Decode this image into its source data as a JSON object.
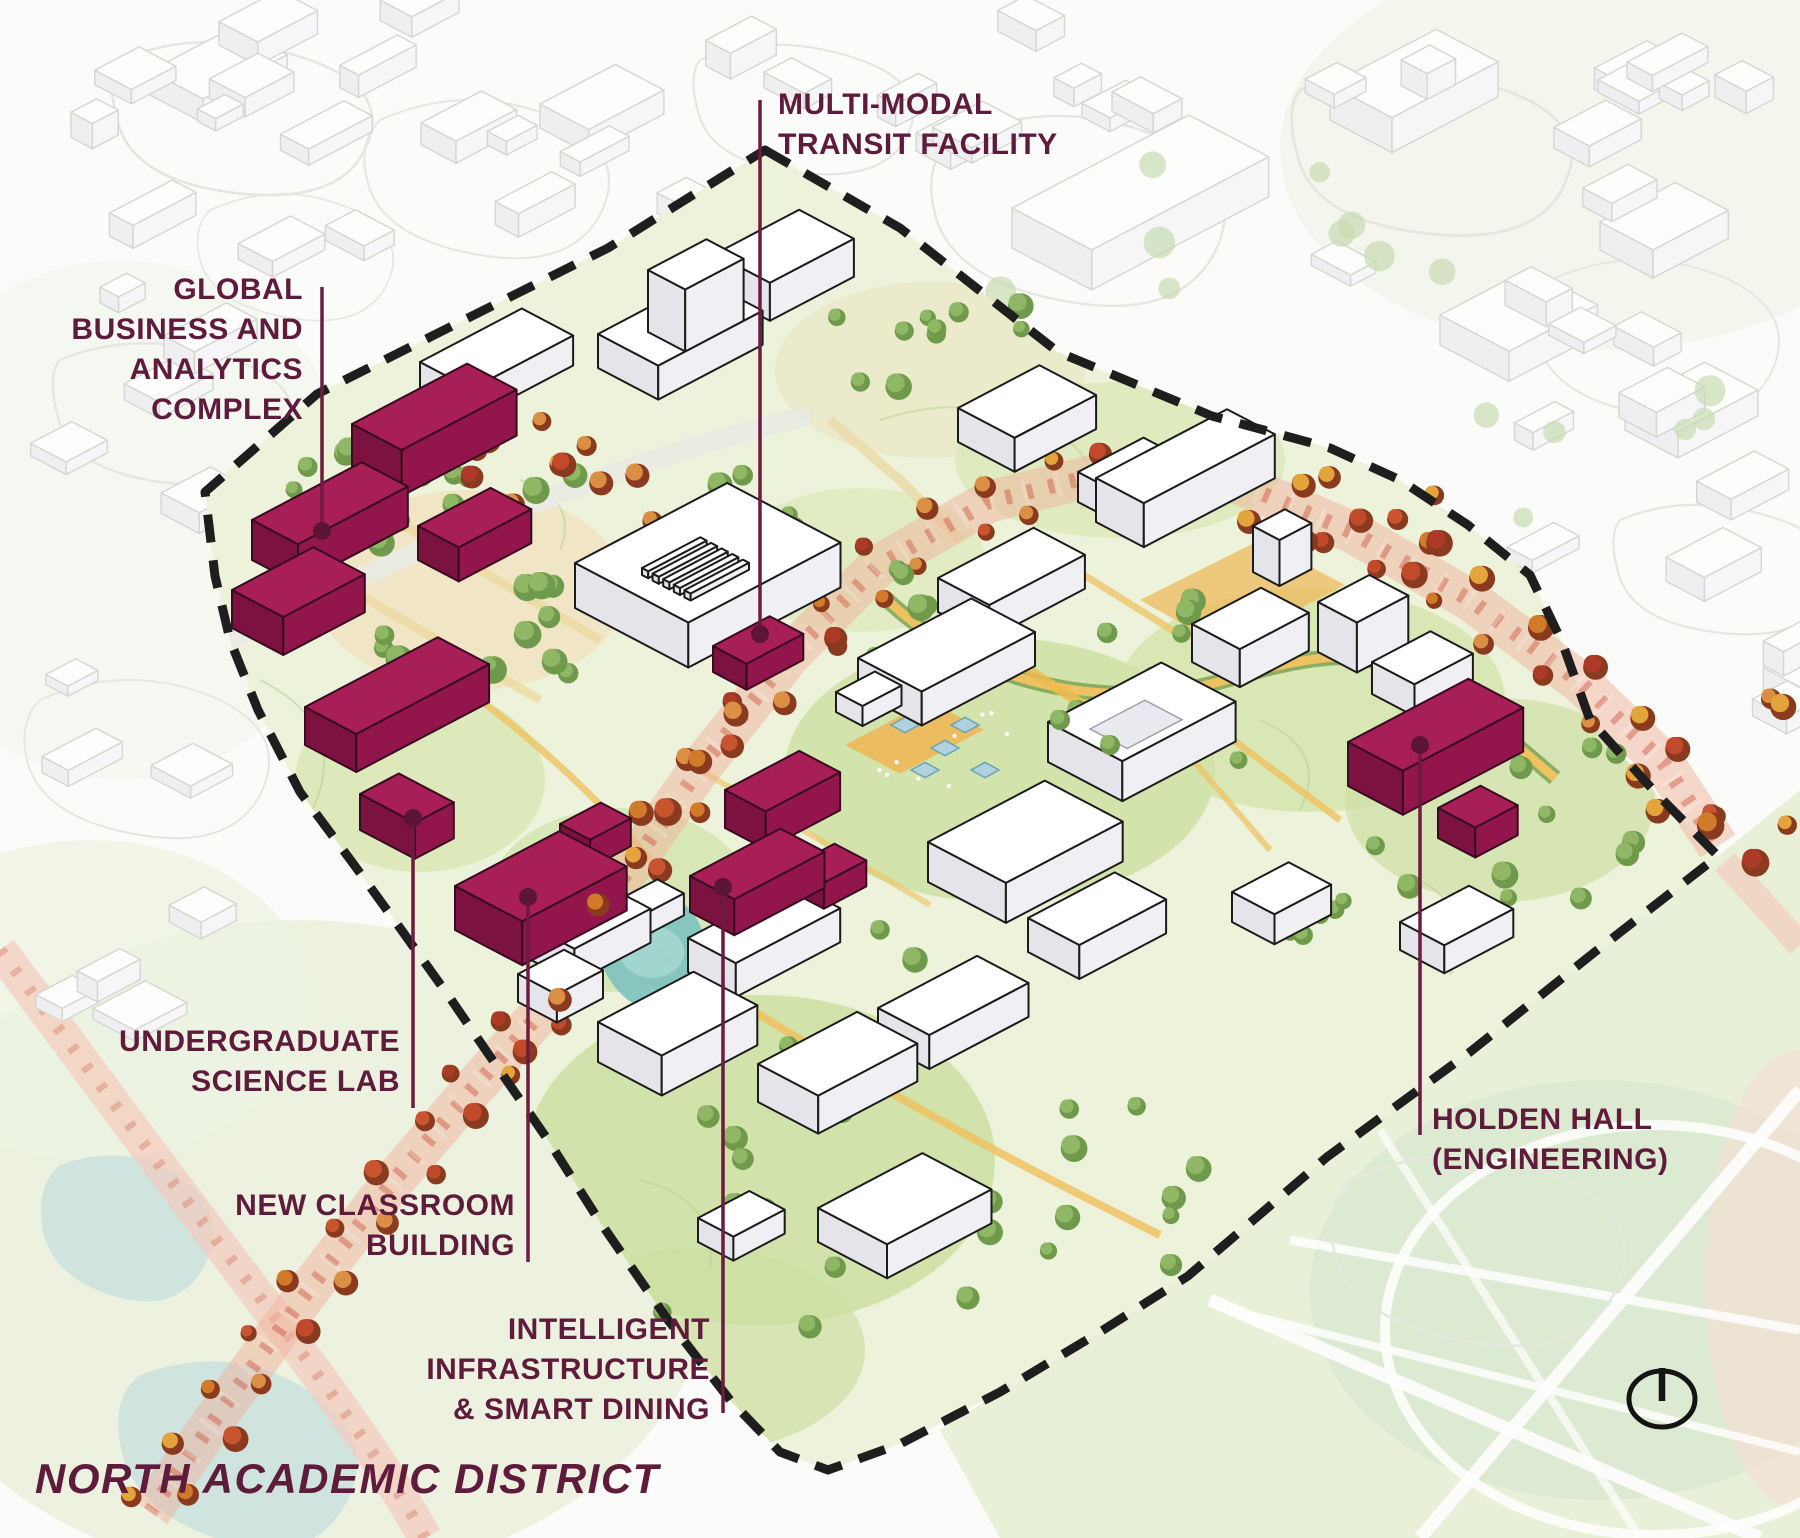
{
  "map_title": "NORTH ACADEMIC DISTRICT",
  "labels": {
    "transit": {
      "lines": [
        "MULTI-MODAL",
        "TRANSIT FACILITY"
      ]
    },
    "global": {
      "lines": [
        "GLOBAL",
        "BUSINESS AND",
        "ANALYTICS",
        "COMPLEX"
      ]
    },
    "science": {
      "lines": [
        "UNDERGRADUATE",
        "SCIENCE LAB"
      ]
    },
    "classroom": {
      "lines": [
        "NEW CLASSROOM",
        "BUILDING"
      ]
    },
    "infrastructure": {
      "lines": [
        "INTELLIGENT",
        "INFRASTRUCTURE",
        "& SMART DINING"
      ]
    },
    "holden": {
      "lines": [
        "HOLDEN HALL",
        "(ENGINEERING)"
      ]
    }
  },
  "icons": {
    "compass": "north-compass"
  },
  "colors": {
    "label_text": "#5f1b3c",
    "leader_line": "#6d1b40",
    "leader_dot": "#5d1535",
    "boundary_dash": "#1e1e1e",
    "highlight_top": "#a81e56",
    "highlight_side_dark": "#7c123f",
    "highlight_side": "#92164b",
    "building_top": "#ffffff",
    "building_side_dark": "#e4e4ea",
    "building_side": "#f0f0f4",
    "building_outline": "#1b1b1b",
    "context_outline": "#d3d7d0",
    "avenue_wash": "#f0b19c",
    "avenue_stripe": "#cc5742",
    "autumn_palette": [
      "#d07a2a",
      "#c24a2c",
      "#e3a43c",
      "#ad3a26",
      "#db8f45",
      "#c8552f"
    ],
    "green_tree_light": "#8fb765",
    "green_tree_dark": "#6f9a4b",
    "context_tree": "#c7dcb2",
    "pond": "#7fc3c0",
    "pond_outer": "#cfe4df",
    "plaza": "#edb95c",
    "canopy_diamond": "#aed3de",
    "field_green": "#e7efd5",
    "district_base": "#edf2da",
    "yellow_path": "#eec261",
    "path_green_edge": "#7ca353",
    "pink_road": "#f4cabc"
  }
}
